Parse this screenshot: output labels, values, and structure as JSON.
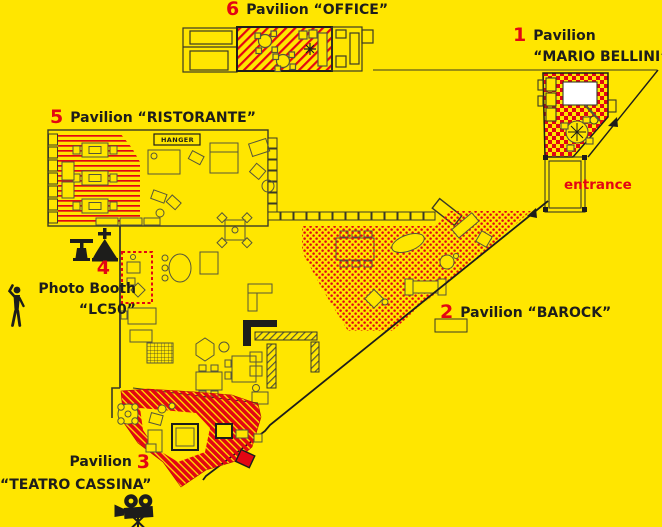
{
  "palette": {
    "background": "#ffe600",
    "accent_red": "#e30613",
    "ink": "#1d1d1b",
    "plan_line": "#3a3a26",
    "furniture_line": "#56563a",
    "white_fill": "#ffffff"
  },
  "labels": {
    "office": {
      "number": "6",
      "title": "Pavilion “OFFICE”"
    },
    "mario_bellini": {
      "number": "1",
      "line1": "Pavilion",
      "line2": "“MARIO BELLINI”"
    },
    "ristorante": {
      "number": "5",
      "title": "Pavilion “RISTORANTE”"
    },
    "photo_booth": {
      "number": "4",
      "line1": "Photo Booth",
      "line2": "“LC50”"
    },
    "barock": {
      "number": "2",
      "title": "Pavilion “BAROCK”"
    },
    "teatro": {
      "number": "3",
      "line1": "Pavilion",
      "line2": "“TEATRO CASSINA”"
    },
    "entrance": "entrance",
    "hanger": "HANGER"
  },
  "icons": {
    "photographer": "photographer-silhouette-icon",
    "studio_lamps": "studio-lamp-icons",
    "film_camera": "film-camera-icon"
  },
  "legend": {
    "pattern_office": "red diagonal hatch",
    "pattern_mario_bellini": "red checkerboard",
    "pattern_ristorante": "red horizontal stripes",
    "pattern_barock": "red dots",
    "pattern_teatro": "dense red hatch"
  }
}
